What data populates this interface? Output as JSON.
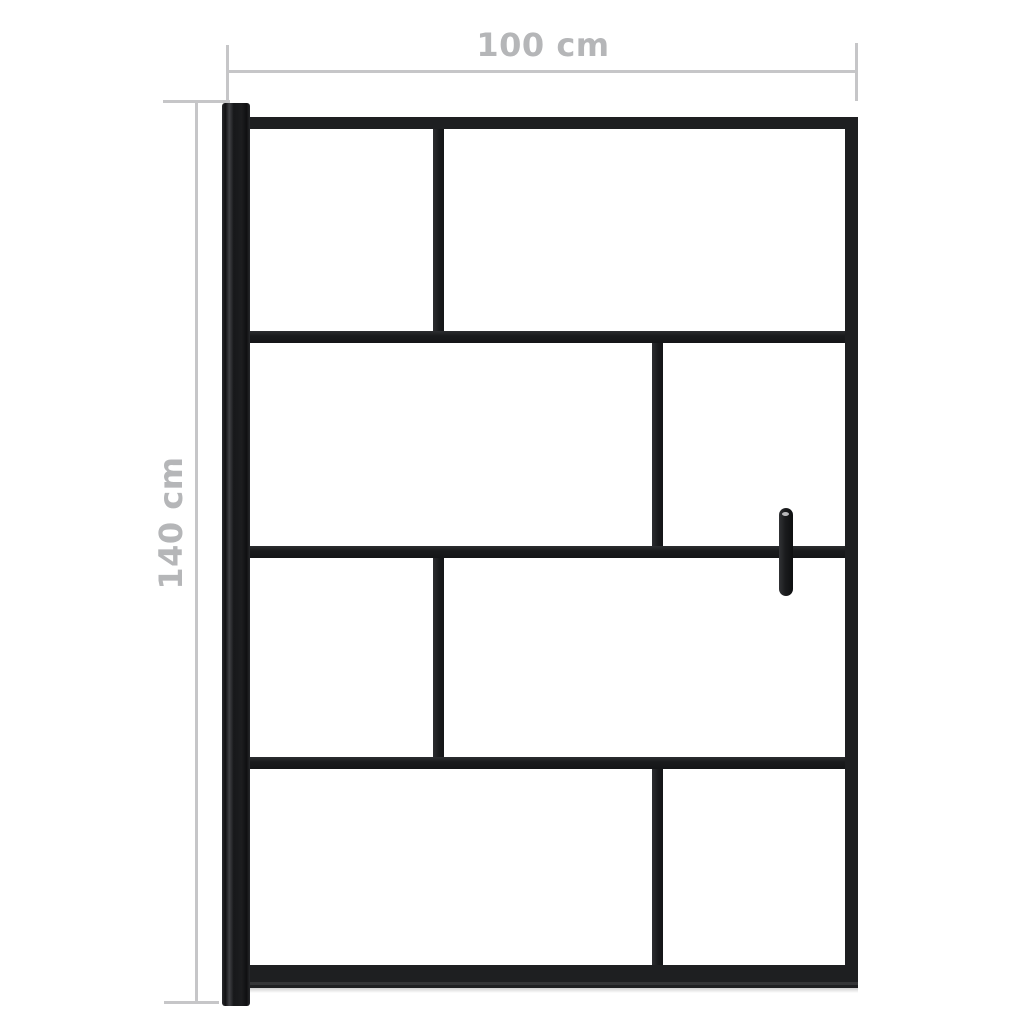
{
  "diagram": {
    "type": "product-dimension-diagram",
    "product": "Shower screen with black frame, staggered glass panes, wall profile and door handle",
    "dimensions": {
      "width_label": "100 cm",
      "height_label": "140 cm"
    },
    "screen": {
      "row_boundaries": [
        0.249,
        0.506,
        0.758
      ],
      "rows": [
        {
          "divider_fraction": 0.317
        },
        {
          "divider_fraction": 0.685
        },
        {
          "divider_fraction": 0.317
        },
        {
          "divider_fraction": 0.685
        }
      ],
      "handle_side": "right"
    },
    "colors": {
      "frame": "#1e1f21",
      "dimension_line": "#c6c6c8",
      "dimension_text": "#b5b6b8",
      "background": "#ffffff"
    }
  }
}
